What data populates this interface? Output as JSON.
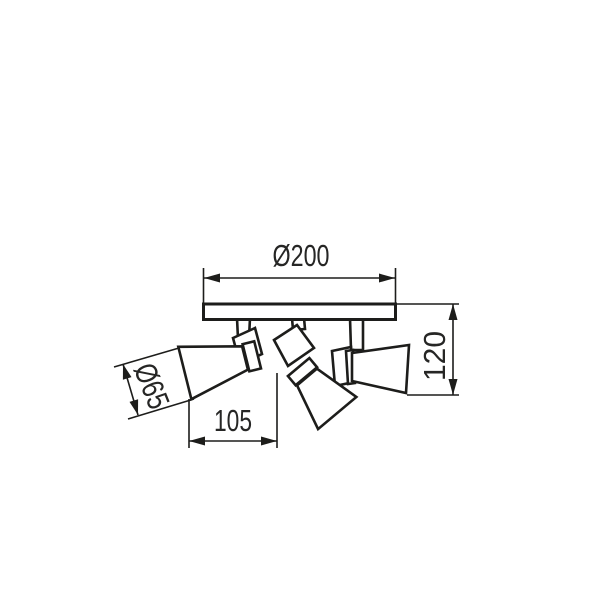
{
  "drawing": {
    "background": "#ffffff",
    "line_color": "#1d1d1b",
    "labels": {
      "top": "Ø200",
      "right": "120",
      "left": "Ø65",
      "bottom": "105"
    }
  }
}
